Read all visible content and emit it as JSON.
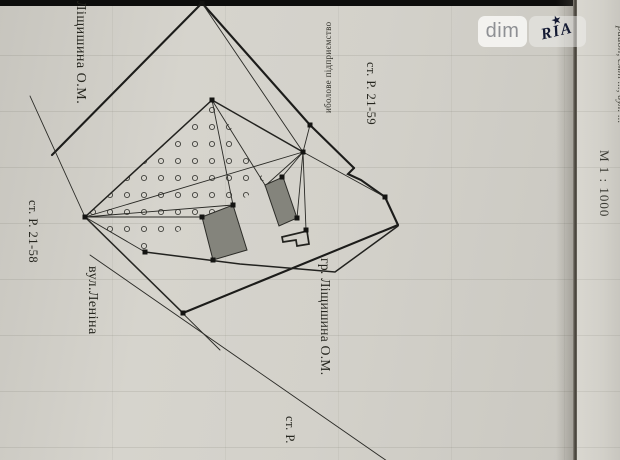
{
  "watermark": {
    "dim_label": "dim",
    "ria_label": "RIA",
    "star": "★"
  },
  "side_panel": {
    "address_line": "район, смт ..., вул. ...",
    "scale": "М 1 : 1000"
  },
  "plan_labels": {
    "owner_top": "Ліщишина О.М.",
    "neighbor_enterprise": "иболове підприємство",
    "station_top_right": "ст. Р. 21-59",
    "station_left": "ст. Р. 21-58",
    "street": "вул.Леніна",
    "neighbor_owner": "гр. Ліщишина О.М.",
    "station_bottom": "ст. Р."
  }
}
